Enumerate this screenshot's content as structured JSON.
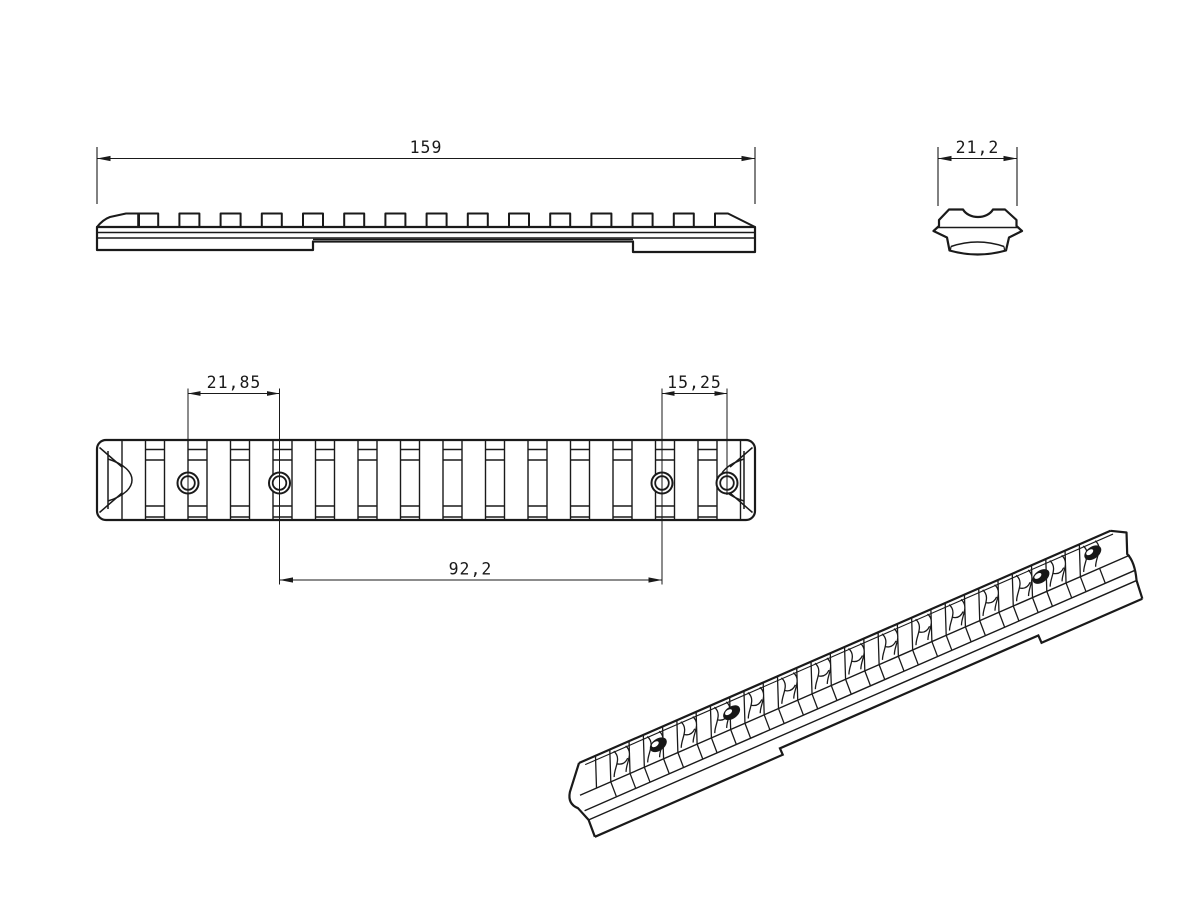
{
  "page": {
    "background": "#ffffff",
    "line_color": "#1a1a1a",
    "drawing_type": "technical-drawing"
  },
  "views": {
    "side": {
      "label": "side-view",
      "dim_length": "159"
    },
    "end": {
      "label": "end-view",
      "dim_width": "21,2"
    },
    "top": {
      "label": "top-view",
      "dim_hole_left": "21,85",
      "dim_hole_right": "15,25",
      "dim_hole_span": "92,2"
    },
    "iso": {
      "label": "isometric-view"
    }
  }
}
